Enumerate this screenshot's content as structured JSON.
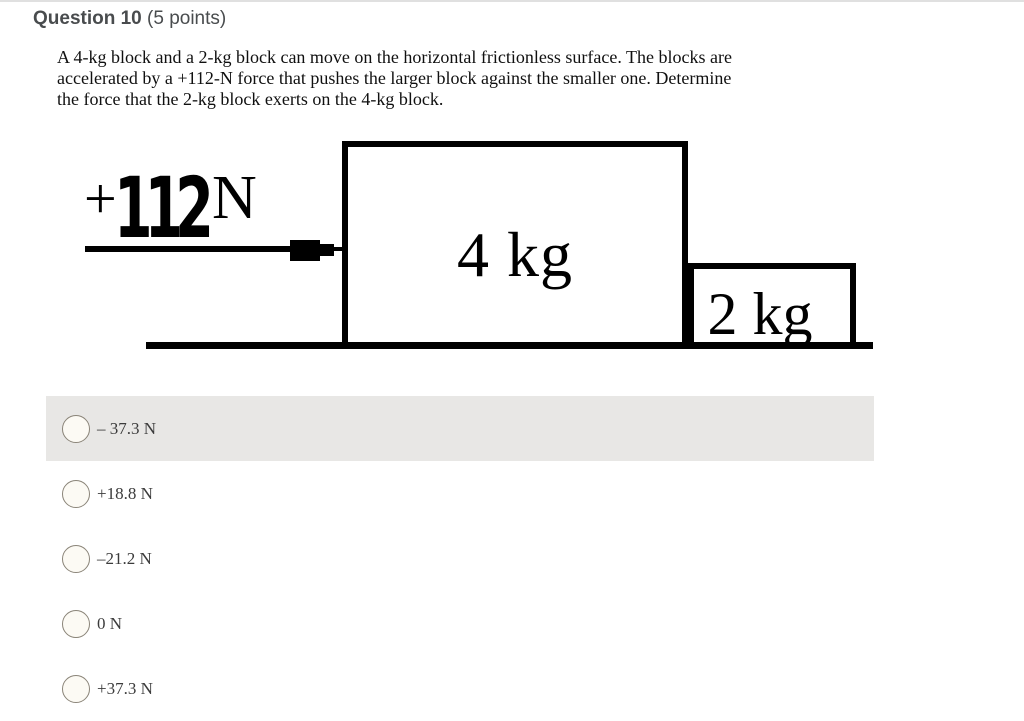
{
  "header": {
    "title": "Question 10",
    "points": "(5 points)"
  },
  "question_lines": [
    "A 4-kg block and a 2-kg block can move on the horizontal frictionless surface.  The blocks are",
    "accelerated by a +112-N force that pushes the larger block against the smaller one.  Determine",
    "the force that the 2-kg block exerts on the 4-kg block."
  ],
  "diagram": {
    "force_sign": "+",
    "force_value": "112",
    "force_unit": "N",
    "large_block_label": "4 kg",
    "small_block_label": "2 kg"
  },
  "options": [
    {
      "label": "– 37.3 N",
      "highlighted": true,
      "selected": false
    },
    {
      "label": "+18.8 N",
      "highlighted": false,
      "selected": false
    },
    {
      "label": "–21.2 N",
      "highlighted": false,
      "selected": false
    },
    {
      "label": "0 N",
      "highlighted": false,
      "selected": false
    },
    {
      "label": "+37.3 N",
      "highlighted": false,
      "selected": false
    }
  ],
  "colors": {
    "highlight_row": "#e8e7e5",
    "header_text": "#494c4e",
    "radio_fill": "#fcfaf4",
    "radio_border": "#8a8478",
    "diagram_ink": "#000000"
  }
}
